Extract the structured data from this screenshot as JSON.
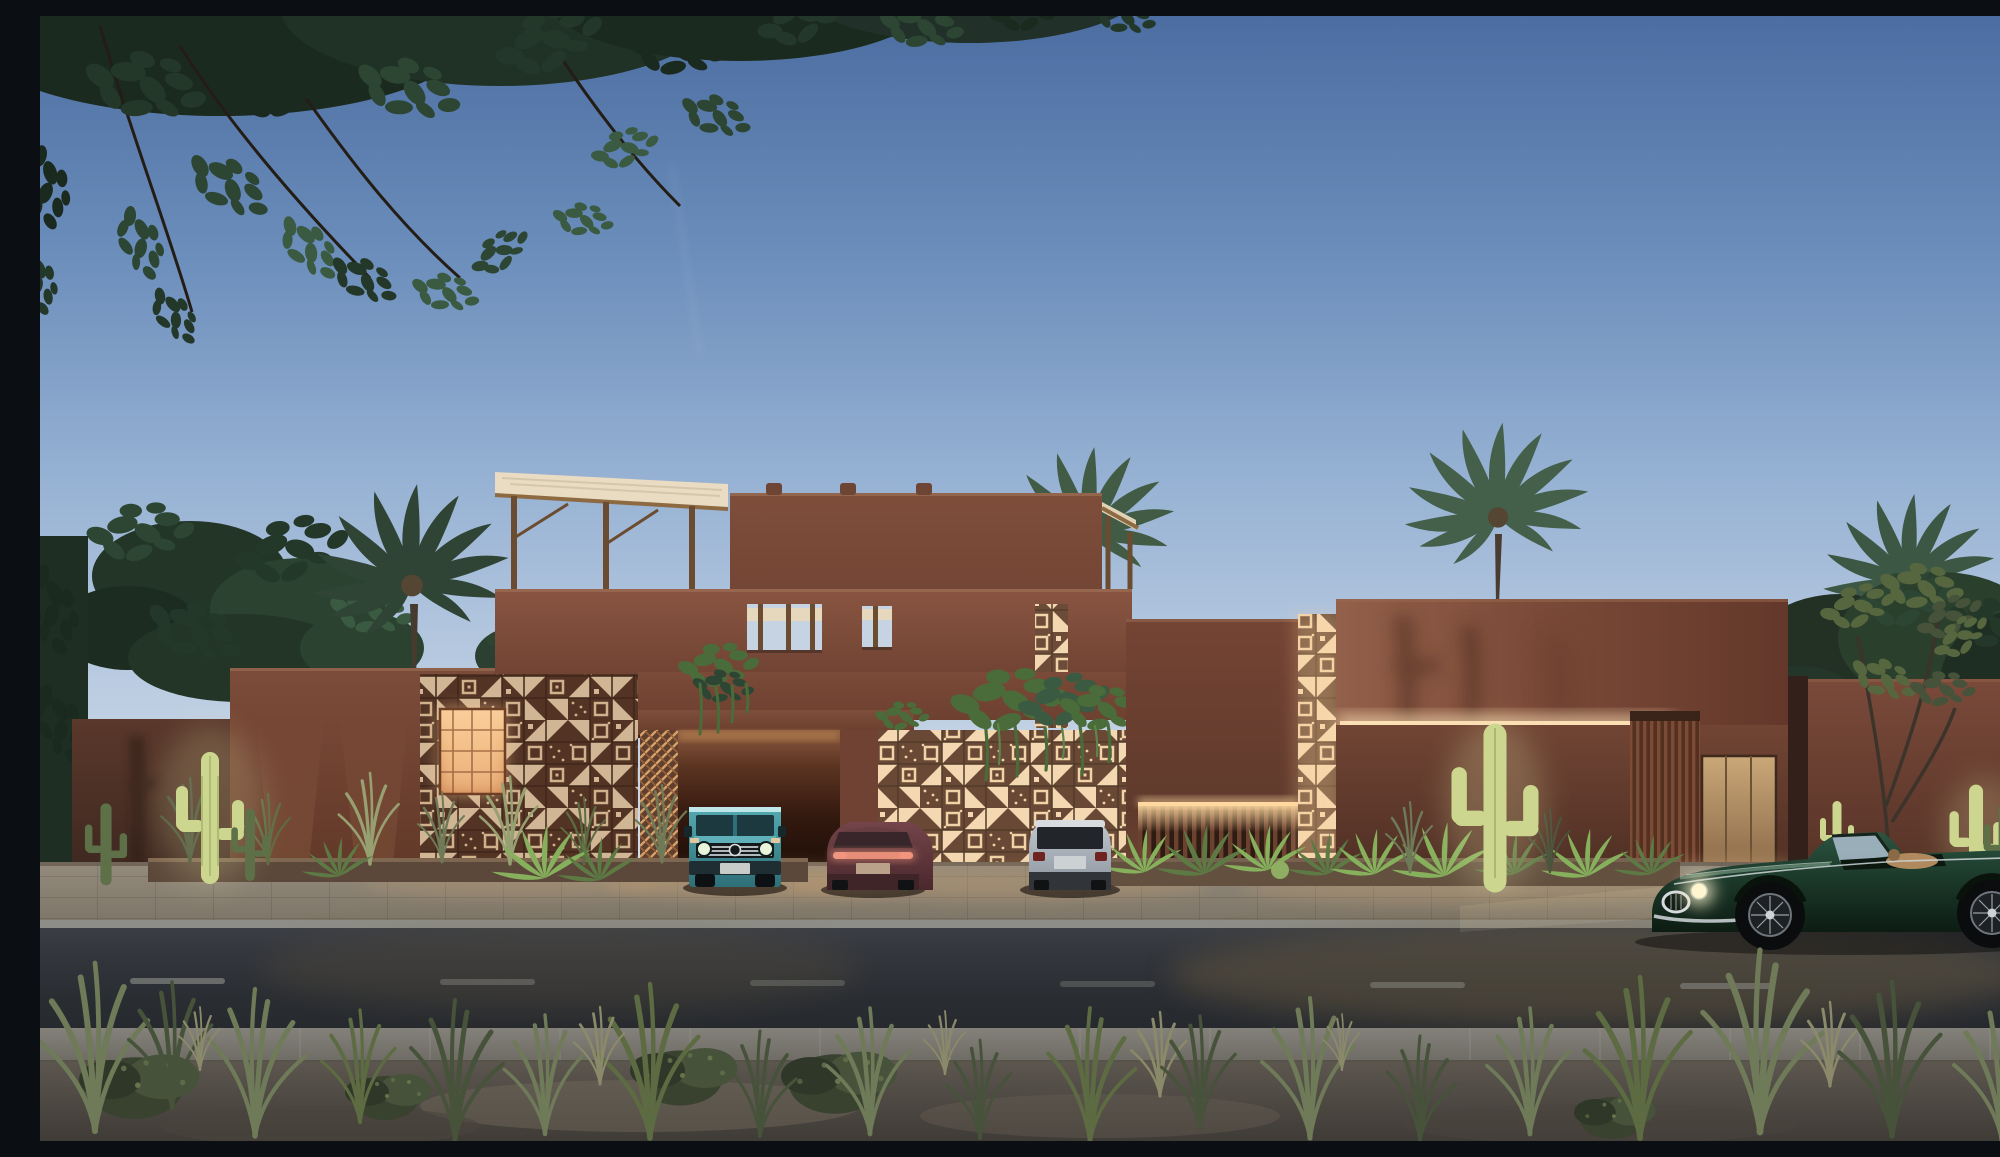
{
  "scene": {
    "title": "Desert modern terracotta villa at dusk — street elevation rendering",
    "description": "Photorealistic architectural rendering of a flat-roofed terracotta villa with backlit perforated masonry screens, a rooftop timber pergola with woven shade canopy, palm trees, uplit saguaro cacti, a teal off-road SUV in a carport, maroon and silver SUVs on the driveway, and a classic green roadster with headlights on driving past on the foreground road under a dusk sky with overhanging acacia foliage.",
    "time_of_day": "dusk",
    "setting": "desert street elevation"
  },
  "palette": {
    "sky_top": "#4b6da1",
    "sky_mid": "#98b3d4",
    "sky_horizon": "#ece8e2",
    "terracotta_light": "#95604a",
    "terracotta_mid": "#7a4a38",
    "terracotta_dark": "#5d392c",
    "terracotta_deep": "#462b21",
    "screen_glow": "#f2d7b1",
    "screen_hot": "#ffe8c2",
    "screen_frame": "#583828",
    "copper_panel": "#d79a66",
    "wood_pergola": "#9a7a4e",
    "canopy_fabric": "#e9dcc2",
    "cove_light": "#f7dcb2",
    "led_strip": "#ffd9a0",
    "road_asphalt": "#2d3036",
    "road_light_pool": "#6b5b41",
    "sidewalk": "#7b7872",
    "pavement": "#8a8174",
    "dirt": "#55504a",
    "grass_green": "#5d6b42",
    "grass_dry": "#8a8a6a",
    "cactus_lit": "#ccd68e",
    "cactus_dim": "#5e7048",
    "foliage_dark": "#24352a",
    "foliage_olive": "#56663f",
    "palm_green": "#3d5540",
    "vine_green": "#4a6b3a",
    "suv_teal": "#3f96a0",
    "suv_maroon": "#6b3c40",
    "suv_silver": "#b6bdc6",
    "roadster_green": "#1d3a2a",
    "headlight_glow": "#fff4c6",
    "taillight_amber": "#d98572"
  },
  "architecture": {
    "material": "terracotta plaster / rammed earth",
    "elements": [
      {
        "name": "rooftop-pergola",
        "detail": "timber beams carrying a pale woven shade canopy"
      },
      {
        "name": "roof-terrace-parapet",
        "detail": "openings with slender timber posts"
      },
      {
        "name": "left-breeze-block-screen",
        "detail": "backlit perforated masonry with glowing copper mesh panel"
      },
      {
        "name": "central-breeze-block-screen",
        "detail": "large backlit perforated masonry wall behind parked cars"
      },
      {
        "name": "vertical-breeze-block-strip",
        "detail": "glowing slot of blocks between volumes"
      },
      {
        "name": "carport",
        "detail": "portal opening with glowing lattice jamb and vines over the header"
      },
      {
        "name": "cantilevered-volume",
        "detail": "warm cove uplight along its underside"
      },
      {
        "name": "timber-slat-screen",
        "detail": "vertical slats beside the entry"
      },
      {
        "name": "entry-door",
        "detail": "pale timber door, warm lit"
      },
      {
        "name": "slatted-fence",
        "detail": "low fence with LED strip on top edge and fern planter"
      },
      {
        "name": "street-planters",
        "detail": "ferns, desert grasses and uplit saguaros along the base"
      }
    ]
  },
  "vehicles": [
    {
      "name": "boxy off-road SUV",
      "color": "teal",
      "view": "front",
      "location": "inside carport",
      "lights": "off"
    },
    {
      "name": "fastback SUV",
      "color": "maroon",
      "view": "rear",
      "location": "driveway",
      "lights": "tail light bar glowing"
    },
    {
      "name": "compact luxury SUV",
      "color": "silver white",
      "view": "rear",
      "location": "driveway",
      "lights": "off"
    },
    {
      "name": "classic roadster convertible",
      "color": "dark racing green",
      "view": "side, driving left",
      "location": "road",
      "lights": "headlights on"
    }
  ],
  "vegetation": {
    "palm_trees": 4,
    "saguaro_cacti": "uplit clusters at the left wall, centre-right wall and far right",
    "trees": "dark canopies behind the walls, overhanging acacia foliage across the top-left, sparse olive-green tree at right",
    "ground_cover": "wild desert grasses and shrubs on the sandy foreground verge"
  },
  "street": {
    "road": "two-lane asphalt with faint dashed centre line",
    "sidewalk": "paved strip on the near side",
    "foreground": "sandy verge with scattered grasses",
    "lighting": "warm pools of light spilling from the facade screens and headlights"
  }
}
